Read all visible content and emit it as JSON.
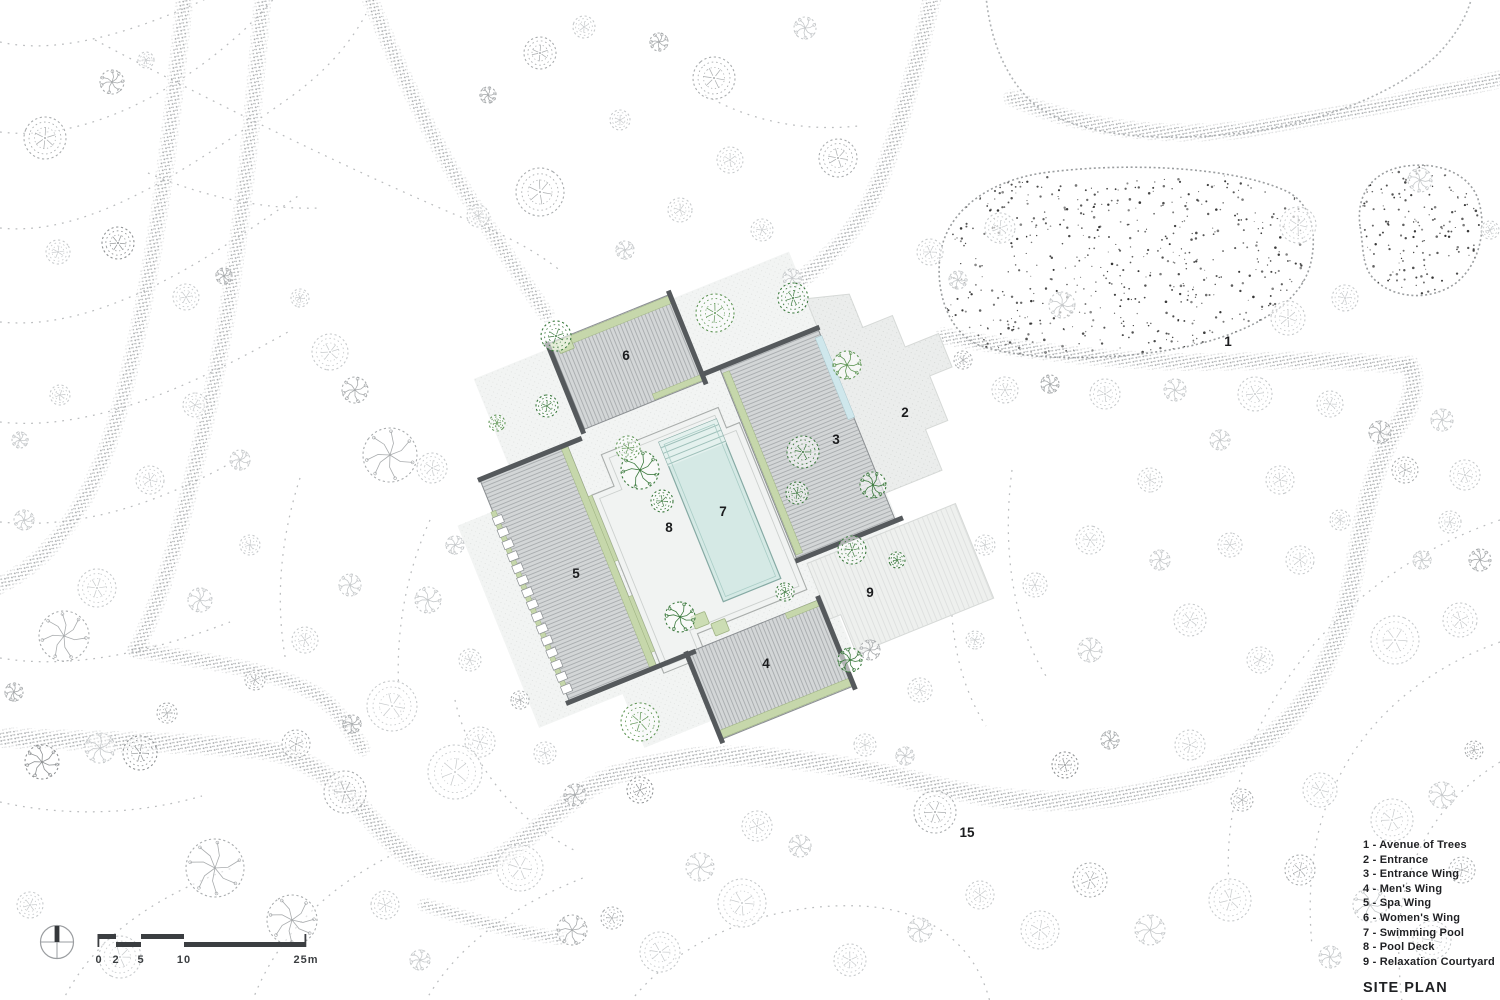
{
  "title": "SITE PLAN",
  "legend": {
    "separator": " - ",
    "items": [
      {
        "num": "1",
        "label": "Avenue of Trees"
      },
      {
        "num": "2",
        "label": "Entrance"
      },
      {
        "num": "3",
        "label": "Entrance Wing"
      },
      {
        "num": "4",
        "label": "Men's Wing"
      },
      {
        "num": "5",
        "label": "Spa Wing"
      },
      {
        "num": "6",
        "label": "Women's Wing"
      },
      {
        "num": "7",
        "label": "Swimming Pool"
      },
      {
        "num": "8",
        "label": "Pool Deck"
      },
      {
        "num": "9",
        "label": "Relaxation Courtyard"
      }
    ]
  },
  "plan_labels": [
    {
      "text": "1",
      "x": 1228,
      "y": 346
    },
    {
      "text": "2",
      "x": 905,
      "y": 417
    },
    {
      "text": "3",
      "x": 836,
      "y": 444
    },
    {
      "text": "4",
      "x": 766,
      "y": 668
    },
    {
      "text": "5",
      "x": 576,
      "y": 578
    },
    {
      "text": "6",
      "x": 626,
      "y": 360
    },
    {
      "text": "7",
      "x": 723,
      "y": 516
    },
    {
      "text": "8",
      "x": 669,
      "y": 532
    },
    {
      "text": "9",
      "x": 870,
      "y": 597
    },
    {
      "text": "15",
      "x": 967,
      "y": 837
    }
  ],
  "scale_bar": {
    "ticks": [
      {
        "label": "0",
        "x": 99
      },
      {
        "label": "2",
        "x": 116
      },
      {
        "label": "5",
        "x": 141
      },
      {
        "label": "10",
        "x": 184
      },
      {
        "label": "25m",
        "x": 306
      }
    ],
    "label_y": 963
  },
  "icons": {
    "north_arrow": "compass-north-icon"
  },
  "colors": {
    "building_fill": "#d3d6d7",
    "building_hatch": "#a7abad",
    "building_edge": "#8b8f92",
    "wall": "#55595c",
    "green_strip": "#c6d7ab",
    "blue_canopy": "#cfe7ec",
    "pool": "#d5e9e5",
    "pool_steps": "#e4f1ee",
    "paving": "#f2f4f3",
    "paving_dark": "#ebedec",
    "road_stipple": "#a2a5a7",
    "contour": "#b2b5b7",
    "tree_gray_light": "#c7cacc",
    "tree_gray_mid": "#a9acae",
    "tree_gray_dark": "#8f9294",
    "tree_green_light": "#8fb07b",
    "tree_green_mid": "#5f9655",
    "tree_green_dark": "#3c7a3e",
    "text": "#1b1c1e",
    "scale_text": "#3b3e41"
  }
}
